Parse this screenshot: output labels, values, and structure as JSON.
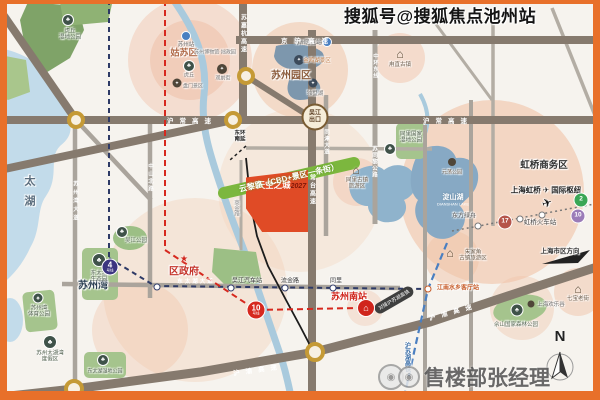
{
  "watermarks": {
    "top": "搜狐号@搜狐焦点池州站",
    "bottom": "售楼部张经理"
  },
  "project": {
    "logo_icon": "⌂",
    "name": "天空之城",
    "year": "2027",
    "block_color": "#e04b26"
  },
  "green_road": {
    "label": "云黎路（CBD+景区一条街）",
    "color": "#7cb73e"
  },
  "expressways": {
    "jinghu": "京沪高速",
    "huchang": "沪常高速",
    "sujiahang": "苏嘉杭高速",
    "changtai": "常台高速",
    "huyu": "沪渝高速"
  },
  "roads": {
    "zhongshan_north": "中山北路",
    "suzhouwan_ave": "苏州湾大道",
    "dongtaihu_ave": "东太湖大道",
    "tongjin_ave": "同津大道",
    "zhonghuan_east": "中环东线",
    "sutongli_rd": "苏同黎公路",
    "shangjin_rd": "商金路"
  },
  "areas": {
    "taihu": "太湖",
    "gusu": "姑苏区",
    "sip": "苏州园区",
    "suzhouwan": "苏州湾",
    "district_gov": "区政府",
    "hongqiao_cbd": "虹桥商务区",
    "hub_left": "上海虹桥",
    "hub_right": "国际枢纽",
    "hongqiao_rail": "虹桥火车站",
    "dianshan": "淀山湖",
    "dianshan_en": "DIANSHAN LAKE",
    "shanghai_dir": "上海市区方向"
  },
  "metro": {
    "sub": "号线",
    "line4": "4",
    "line10_red": "10",
    "line17": "17",
    "line2": "2",
    "line10_purple": "10",
    "st_wujiang_bus": "吴江汽车站",
    "st_liujin": "流金路",
    "st_tongli": "同里",
    "st_jiangnan": "江南水乡客厅站",
    "st_dongfanglvzhou": "东方绿舟"
  },
  "rail": {
    "suzhou_south": "苏州南站",
    "hsr_vertical": "沪苏湖高铁",
    "connect_banner": "对接沪苏湖高铁",
    "suzhou_station": "苏州站",
    "sip_station": "苏州园区站"
  },
  "markers": {
    "wujiang_exit_l1": "吴江",
    "wujiang_exit_l2": "出口",
    "dongring_l1": "东环",
    "dongring_l2": "南延"
  },
  "pois": {
    "museum": "苏州博物馆·拙政园",
    "huqiu": "虎丘",
    "guanqian": "观前街",
    "panmen": "盘门景区",
    "jinji_lake": "金鸡湖景区",
    "dushu_lake": "独墅湖",
    "luzhi": "甪直古镇",
    "tongli_town_l1": "同里古镇",
    "tongli_town_l2": "旅游区",
    "zhujiajiao_l1": "朱家角",
    "zhujiajiao_l2": "古镇旅游区",
    "qibao": "七宝老街",
    "happy_valley": "上海欢乐谷",
    "sheshan": "佘山国家森林公园",
    "yuandang": "元荡公园",
    "huqiu_wet_l1": "虎丘",
    "huqiu_wet_l2": "湿地公园",
    "wujiang_park": "吴江公园",
    "dongtaihu_eco_l1": "东太湖",
    "dongtaihu_eco_l2": "生态园",
    "sports_l1": "苏州湾",
    "sports_l2": "体育公园",
    "resort_l1": "苏州太湖湾",
    "resort_l2": "度假区",
    "dongtaihu_wet": "东太湖湿地公园",
    "tongli_wet_l1": "同里国家",
    "tongli_wet_l2": "湿地公园"
  },
  "compass": {
    "n": "N"
  },
  "colors": {
    "frame": "#e8702a",
    "metro_red": "#d6281e",
    "line4_purple": "#3b3580",
    "line17": "#b5544a",
    "line2_green": "#3aa655",
    "line10_purple": "#9b7cb8",
    "water": "#c2dbea",
    "green": "#a5c48d"
  }
}
